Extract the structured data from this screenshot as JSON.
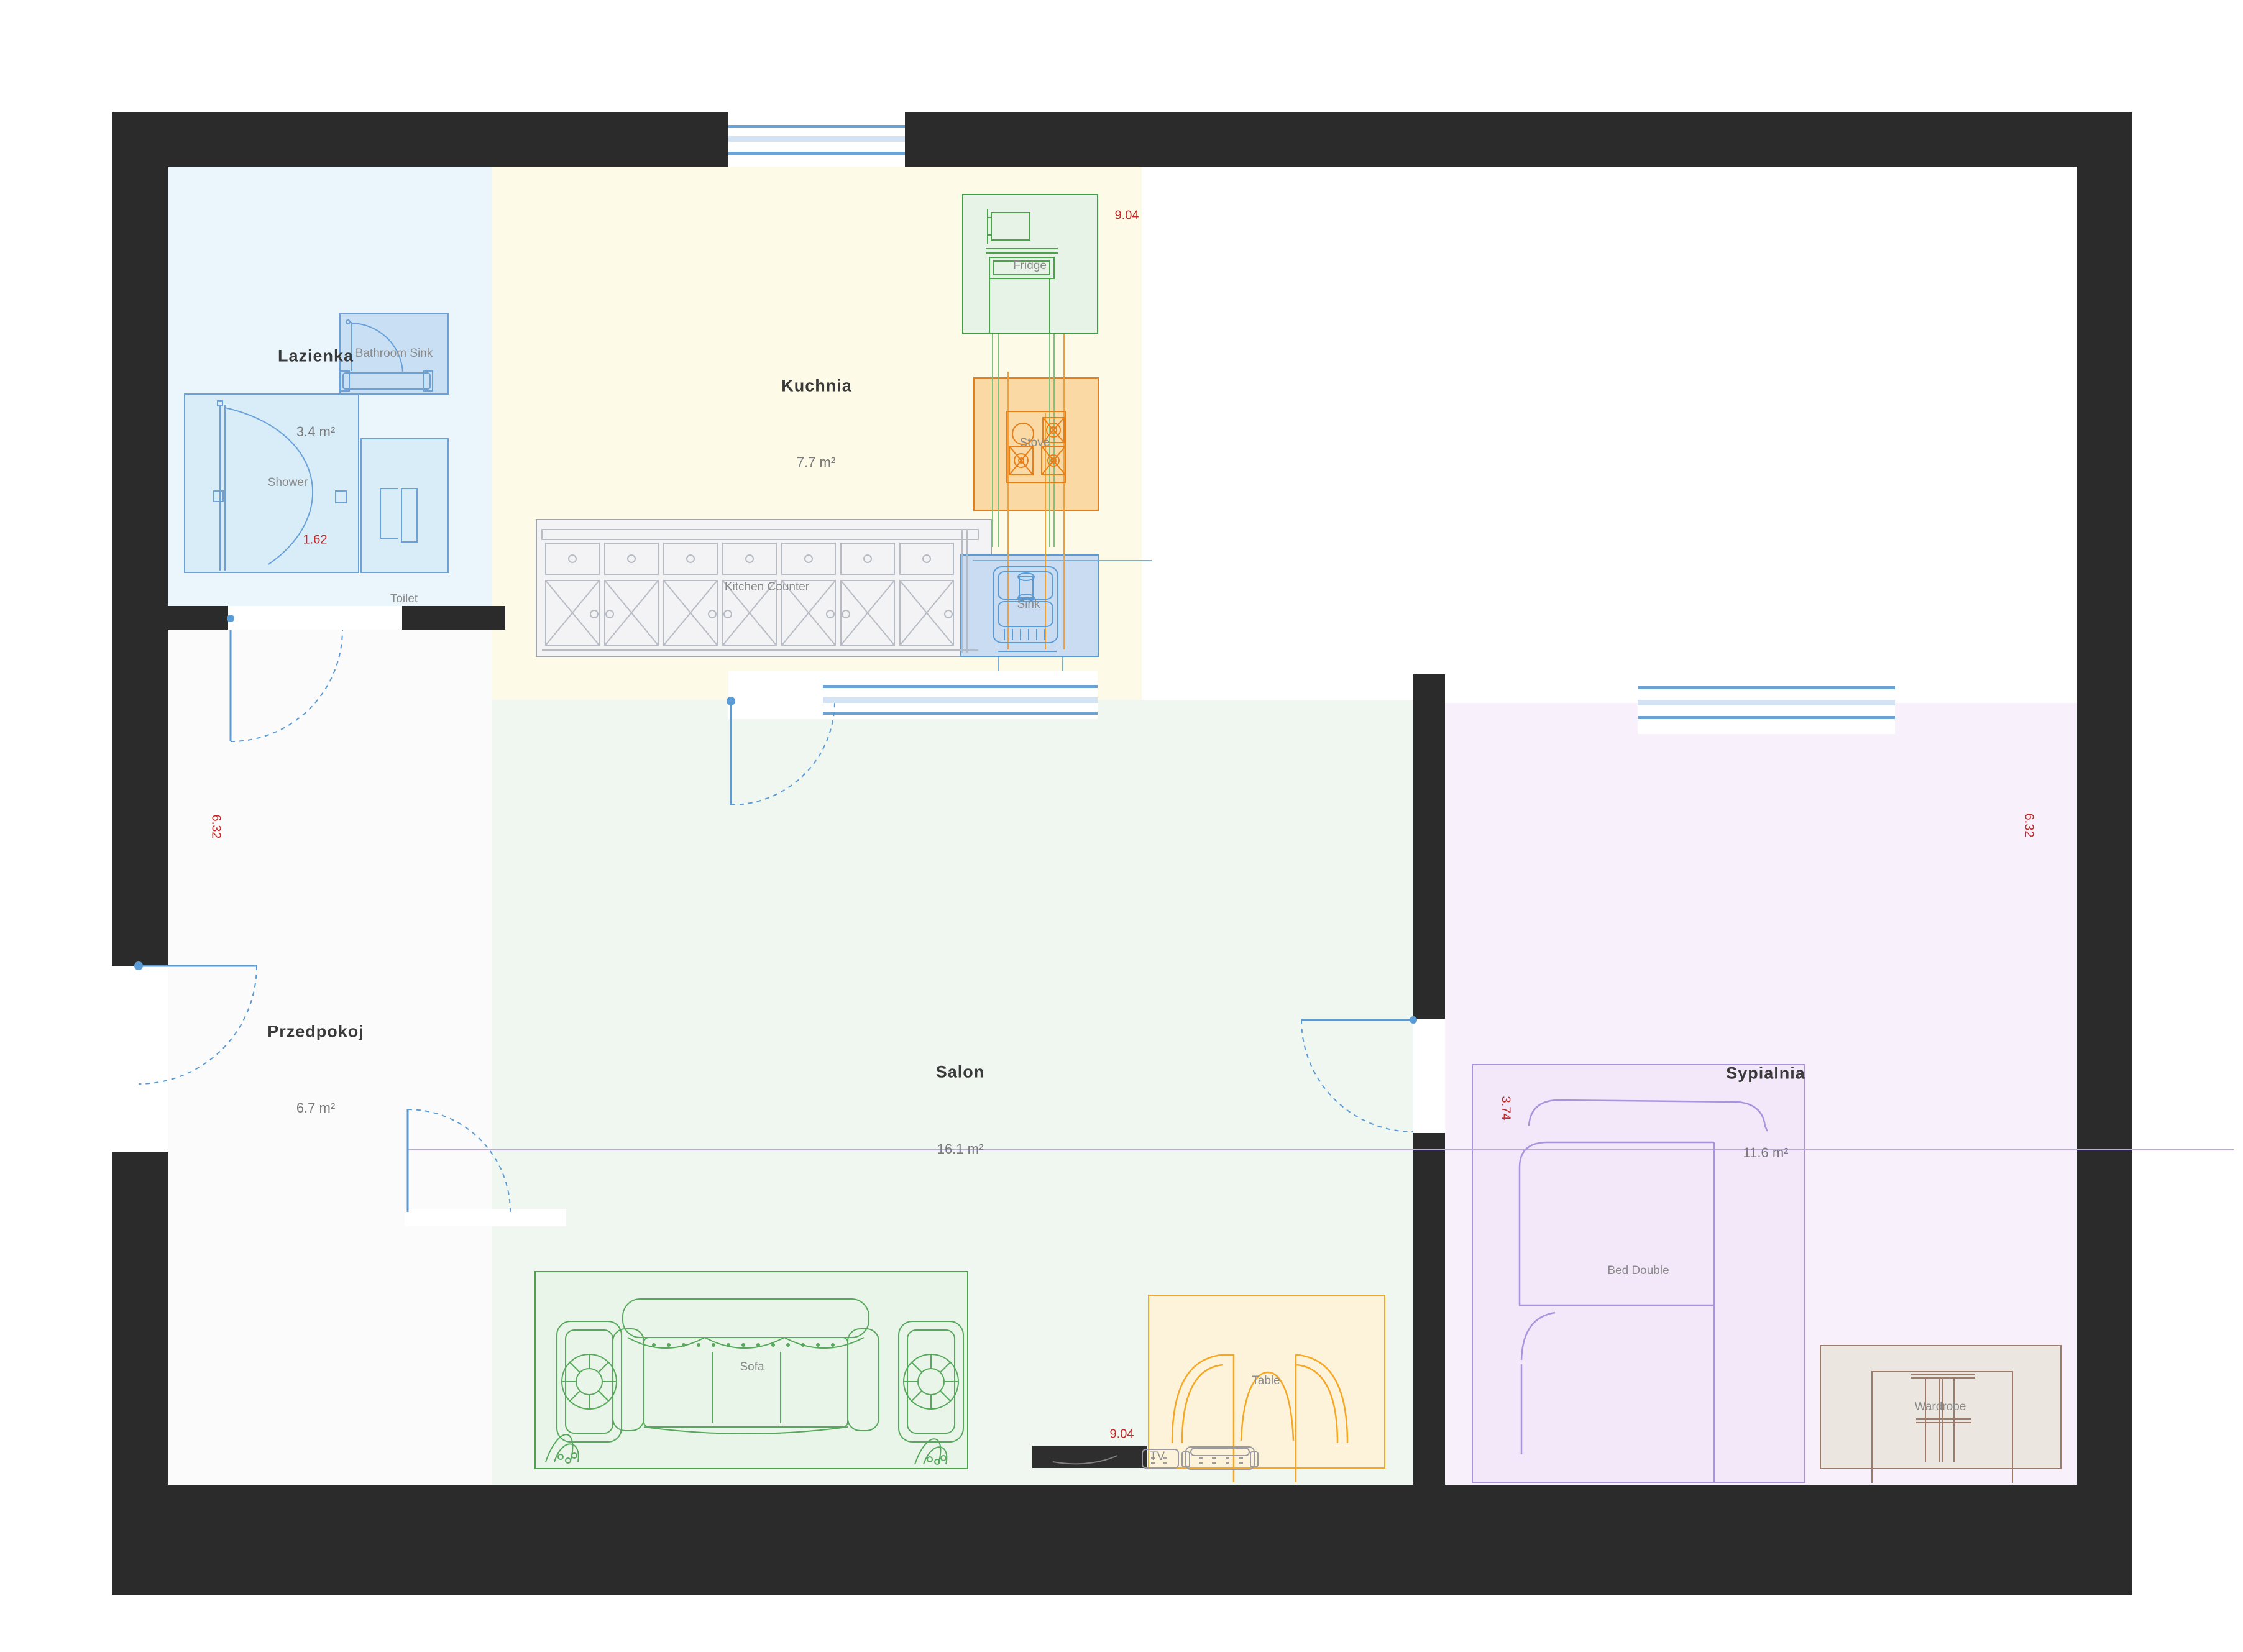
{
  "rooms": {
    "lazienka": {
      "name": "Lazienka",
      "area": "3.4 m²"
    },
    "kuchnia": {
      "name": "Kuchnia",
      "area": "7.7 m²"
    },
    "przedpokoj": {
      "name": "Przedpokoj",
      "area": "6.7 m²"
    },
    "salon": {
      "name": "Salon",
      "area": "16.1 m²"
    },
    "sypialnia": {
      "name": "Sypialnia",
      "area": "11.6 m²"
    }
  },
  "furniture": {
    "bathroom_sink": {
      "label": "Bathroom Sink"
    },
    "shower": {
      "label": "Shower"
    },
    "toilet": {
      "label": "Toilet"
    },
    "fridge": {
      "label": "Fridge"
    },
    "stove": {
      "label": "Stove"
    },
    "sink": {
      "label": "Sink"
    },
    "kitchen_counter": {
      "label": "Kitchen Counter"
    },
    "sofa": {
      "label": "Sofa"
    },
    "table": {
      "label": "Table"
    },
    "tv": {
      "label": "TV"
    },
    "bed": {
      "label": "Bed Double"
    },
    "wardrobe": {
      "label": "Wardrobe"
    }
  },
  "dimensions": {
    "kitchen_width": "9.04",
    "shower_width": "1.62",
    "left_height": "6.32",
    "right_height": "6.32",
    "bedroom_width": "3.74",
    "bottom_width": "9.04"
  },
  "colors": {
    "wall": "#2b2b2b",
    "bathroom_fill": "#eaf6fc",
    "kitchen_fill": "#fdfbe7",
    "hallway_fill": "#fafbfa",
    "salon_fill": "#eff7f0",
    "bedroom_fill": "#f8f1fb",
    "dimension_red": "#c82828",
    "window_blue": "#6ba3d6",
    "door_blue": "#5b9bd5",
    "fridge_green": "#3f9e46",
    "stove_orange": "#e87e17",
    "sofa_green": "#4aa54a",
    "table_orange": "#f5a623",
    "bed_purple": "#a893dd",
    "wardrobe_brown": "#9c7b6b"
  }
}
